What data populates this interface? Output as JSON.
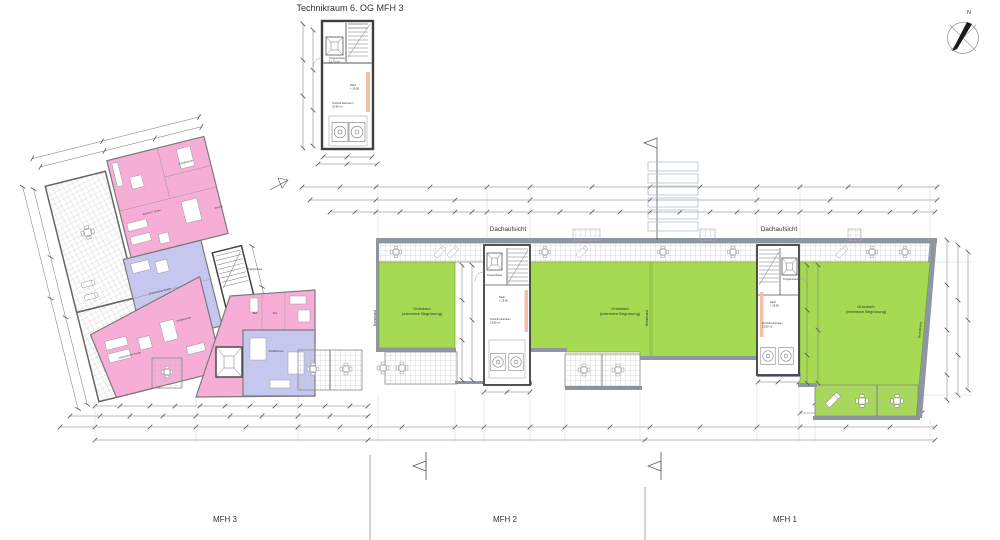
{
  "title": "Technikraum 6. OG MFH 3",
  "compass": {
    "north": "N"
  },
  "roof": {
    "dachaufsicht": "Dachaufsicht",
    "gruendach_line1": "Gründach",
    "gruendach_line2": "(extensive Begrünung)",
    "brandwand": "Brandwand"
  },
  "stairwell_labels": {
    "treppenhaus": "Treppenhaus",
    "treppenhaus_area": "12,71 m²",
    "dach": "Dach",
    "dach_level": "+ 19,90",
    "technik": "Technik Heizraum",
    "technik_area": "23,80 m²"
  },
  "room_labels": {
    "schlafzimmer": "Schlafzimmer",
    "wohnzimmer_kueche": "Wohnzimmer Küche",
    "wohnen_essen": "Wohnen / Essen",
    "zimmer": "Zimmer",
    "bad": "Bad",
    "flur": "Flur"
  },
  "buildings": {
    "mfh3": "MFH 3",
    "mfh2": "MFH 2",
    "mfh1": "MFH 1"
  },
  "colors": {
    "apartment_pink": "#f6aed6",
    "apartment_lavender": "#c6c7ef",
    "green_roof": "#a6da52",
    "wall_gray": "#8f96a3",
    "shaft_orange": "#f2bfa8",
    "outline_blue": "#b5c2d3"
  }
}
